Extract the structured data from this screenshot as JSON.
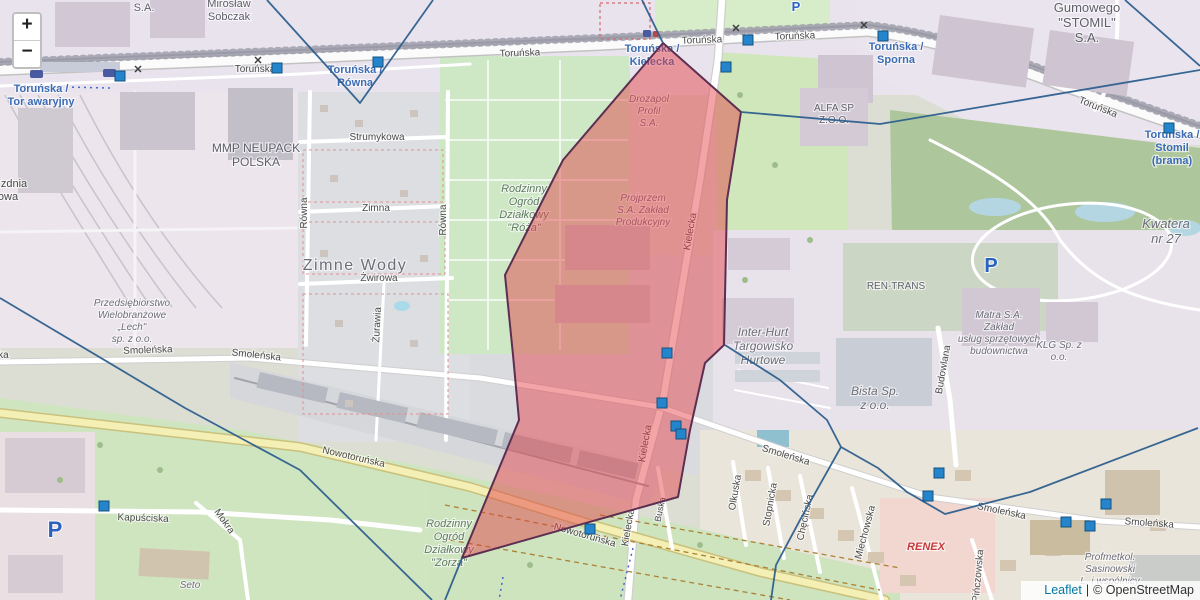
{
  "zoom_control": {
    "zoom_in": "+",
    "zoom_out": "−"
  },
  "attribution": {
    "leaflet_link": "Leaflet",
    "separator": "|",
    "osm_credit": "© OpenStreetMap"
  },
  "map_overlay": {
    "highlight_polygon": {
      "fill": "rgba(228,62,68,0.47)",
      "stroke": "#5c2e52",
      "points": [
        [
          663,
          43
        ],
        [
          741,
          112
        ],
        [
          727,
          200
        ],
        [
          724,
          345
        ],
        [
          705,
          363
        ],
        [
          690,
          430
        ],
        [
          678,
          497
        ],
        [
          462,
          558
        ],
        [
          519,
          420
        ],
        [
          513,
          355
        ],
        [
          505,
          275
        ],
        [
          563,
          160
        ]
      ]
    },
    "boundary_lines": {
      "color": "#2e5f8e",
      "paths": [
        [
          [
            267,
            0
          ],
          [
            360,
            103
          ],
          [
            433,
            0
          ]
        ],
        [
          [
            642,
            0
          ],
          [
            663,
            43
          ]
        ],
        [
          [
            741,
            112
          ],
          [
            880,
            124
          ],
          [
            1200,
            70
          ]
        ],
        [
          [
            1125,
            0
          ],
          [
            1200,
            66
          ]
        ],
        [
          [
            0,
            298
          ],
          [
            185,
            408
          ],
          [
            300,
            470
          ],
          [
            432,
            600
          ]
        ],
        [
          [
            462,
            558
          ],
          [
            445,
            600
          ]
        ],
        [
          [
            725,
            345
          ],
          [
            780,
            380
          ],
          [
            827,
            420
          ],
          [
            841,
            447
          ],
          [
            878,
            468
          ],
          [
            907,
            492
          ],
          [
            945,
            514
          ],
          [
            1030,
            492
          ],
          [
            1198,
            428
          ]
        ],
        [
          [
            841,
            447
          ],
          [
            800,
            520
          ],
          [
            776,
            565
          ],
          [
            771,
            600
          ]
        ]
      ]
    },
    "markers": {
      "color": "#2484cc",
      "border": "#15527e",
      "positions": [
        [
          120,
          76
        ],
        [
          277,
          68
        ],
        [
          378,
          62
        ],
        [
          726,
          67
        ],
        [
          748,
          40
        ],
        [
          883,
          36
        ],
        [
          1169,
          128
        ],
        [
          667,
          353
        ],
        [
          662,
          403
        ],
        [
          676,
          426
        ],
        [
          681,
          434
        ],
        [
          590,
          529
        ],
        [
          104,
          506
        ],
        [
          939,
          473
        ],
        [
          928,
          496
        ],
        [
          1066,
          522
        ],
        [
          1090,
          526
        ],
        [
          1106,
          504
        ]
      ]
    },
    "parking_icons": [
      {
        "x": 796,
        "y": 11,
        "s": 13
      },
      {
        "x": 991,
        "y": 272,
        "s": 20
      },
      {
        "x": 55,
        "y": 537,
        "s": 22
      }
    ],
    "crossing_icons": [
      [
        138,
        73
      ],
      [
        258,
        64
      ],
      [
        736,
        32
      ],
      [
        864,
        29
      ]
    ],
    "labels": [
      {
        "t": "Toruńska /\nTor awaryjny",
        "x": 41,
        "y": 92,
        "s": 11,
        "c": "stop"
      },
      {
        "t": "Toruńska /\nRówna",
        "x": 355,
        "y": 73,
        "s": 11,
        "c": "stop"
      },
      {
        "t": "Toruńska /\nKielecka",
        "x": 652,
        "y": 52,
        "s": 11,
        "c": "stop"
      },
      {
        "t": "Toruńska /\nSporna",
        "x": 896,
        "y": 50,
        "s": 11,
        "c": "stop"
      },
      {
        "t": "Toruńska /\nStomil\n(brama)",
        "x": 1172,
        "y": 138,
        "s": 11,
        "c": "stop"
      },
      {
        "t": "Toruńska",
        "x": 255,
        "y": 72,
        "s": 10,
        "c": "street"
      },
      {
        "t": "Toruńska",
        "x": 520,
        "y": 56,
        "s": 10,
        "c": "street",
        "r": -2
      },
      {
        "t": "Toruńska",
        "x": 702,
        "y": 43,
        "s": 10,
        "c": "street",
        "r": -2
      },
      {
        "t": "Toruńska",
        "x": 795,
        "y": 39,
        "s": 10,
        "c": "street",
        "r": -2
      },
      {
        "t": "Toruńska",
        "x": 1097,
        "y": 110,
        "s": 10,
        "c": "street",
        "r": 22
      },
      {
        "t": "Strumykowa",
        "x": 377,
        "y": 140,
        "s": 10,
        "c": "street"
      },
      {
        "t": "Zimna",
        "x": 376,
        "y": 211,
        "s": 10,
        "c": "street"
      },
      {
        "t": "Żwirowa",
        "x": 379,
        "y": 281,
        "s": 10,
        "c": "street"
      },
      {
        "t": "Równa",
        "x": 307,
        "y": 213,
        "s": 10,
        "c": "street",
        "r": -90
      },
      {
        "t": "Równa",
        "x": 446,
        "y": 220,
        "s": 10,
        "c": "street",
        "r": -90
      },
      {
        "t": "Żurawia",
        "x": 380,
        "y": 325,
        "s": 10,
        "c": "street",
        "r": -87
      },
      {
        "t": "Smoleńska",
        "x": 148,
        "y": 353,
        "s": 10,
        "c": "street",
        "r": -2
      },
      {
        "t": "Smoleńska",
        "x": 256,
        "y": 358,
        "s": 10,
        "c": "street",
        "r": 6
      },
      {
        "t": "Smoleńska",
        "x": 785,
        "y": 458,
        "s": 10,
        "c": "street",
        "r": 17
      },
      {
        "t": "Smoleńska",
        "x": 1001,
        "y": 514,
        "s": 10,
        "c": "street",
        "r": 12
      },
      {
        "t": "Smoleńska",
        "x": 1149,
        "y": 526,
        "s": 10,
        "c": "street",
        "r": 4
      },
      {
        "t": "Smoleńska",
        "x": -16,
        "y": 358,
        "s": 10,
        "c": "street"
      },
      {
        "t": "Nowotoruńska",
        "x": 353,
        "y": 460,
        "s": 10,
        "c": "street",
        "r": 13
      },
      {
        "t": "Nowotoruńska",
        "x": 584,
        "y": 538,
        "s": 10,
        "c": "street",
        "r": 16
      },
      {
        "t": "Kapuściska",
        "x": 143,
        "y": 521,
        "s": 10,
        "c": "street",
        "r": 2
      },
      {
        "t": "Mokra",
        "x": 222,
        "y": 523,
        "s": 10,
        "c": "street",
        "r": 55
      },
      {
        "t": "Seto",
        "x": 190,
        "y": 588,
        "s": 10,
        "c": "co"
      },
      {
        "t": "Kielecka",
        "x": 693,
        "y": 232,
        "s": 10,
        "c": "street",
        "r": -80
      },
      {
        "t": "Kielecka",
        "x": 648,
        "y": 444,
        "s": 10,
        "c": "street",
        "r": -80
      },
      {
        "t": "Kielecka",
        "x": 631,
        "y": 528,
        "s": 10,
        "c": "street",
        "r": -80
      },
      {
        "t": "Buska",
        "x": 663,
        "y": 510,
        "s": 9,
        "c": "street",
        "r": -78
      },
      {
        "t": "Olkuska",
        "x": 738,
        "y": 493,
        "s": 10,
        "c": "street",
        "r": -80
      },
      {
        "t": "Stopnicka",
        "x": 773,
        "y": 505,
        "s": 10,
        "c": "street",
        "r": -80
      },
      {
        "t": "Chęcińska",
        "x": 808,
        "y": 518,
        "s": 10,
        "c": "street",
        "r": -78
      },
      {
        "t": "Miechowska",
        "x": 868,
        "y": 533,
        "s": 10,
        "c": "street",
        "r": -75
      },
      {
        "t": "Pińczowska",
        "x": 981,
        "y": 576,
        "s": 10,
        "c": "street",
        "r": -85
      },
      {
        "t": "Budowlana",
        "x": 946,
        "y": 370,
        "s": 10,
        "c": "street",
        "r": -80
      },
      {
        "t": "zdnia",
        "x": 14,
        "y": 187,
        "s": 11,
        "c": "street"
      },
      {
        "t": "owa",
        "x": 8,
        "y": 200,
        "s": 11,
        "c": "street"
      },
      {
        "t": "Zimne Wody",
        "x": 355,
        "y": 270,
        "s": 16,
        "c": "place"
      },
      {
        "t": "S.A.",
        "x": 144,
        "y": 11,
        "s": 11,
        "c": "co2"
      },
      {
        "t": "Mirosław\nSobczak",
        "x": 229,
        "y": 7,
        "s": 11,
        "c": "co2"
      },
      {
        "t": "MMP NEUPACK\nPOLSKA",
        "x": 256,
        "y": 152,
        "s": 12,
        "c": "co2"
      },
      {
        "t": "Gumowego\n\"STOMIL\"\nS.A.",
        "x": 1087,
        "y": 12,
        "s": 13,
        "c": "co2"
      },
      {
        "t": "Drozapol\nProfil\nS.A.",
        "x": 649,
        "y": 102,
        "s": 10,
        "c": "co"
      },
      {
        "t": "Rodzinny\nOgród\nDziałkowy\n\"Róża\"",
        "x": 524,
        "y": 192,
        "s": 11,
        "c": "green"
      },
      {
        "t": "Rodzinny\nOgród\nDziałkowy\n\"Zorza\"",
        "x": 449,
        "y": 527,
        "s": 11,
        "c": "green"
      },
      {
        "t": "Projprzem\nS.A. Zakład\nProdukcyjny",
        "x": 643,
        "y": 201,
        "s": 10,
        "c": "co"
      },
      {
        "t": "ALFA SP\nZ.O.O.",
        "x": 834,
        "y": 111,
        "s": 10,
        "c": "co2"
      },
      {
        "t": "Przedsiębiorstwo\nWielobranżowe\n„Lech\"\nsp. z o.o.",
        "x": 132,
        "y": 306,
        "s": 10,
        "c": "co"
      },
      {
        "t": "REN-TRANS",
        "x": 896,
        "y": 289,
        "s": 10,
        "c": "co2"
      },
      {
        "t": "Inter-Hurt\nTargowisko\nHurtowe",
        "x": 763,
        "y": 336,
        "s": 12,
        "c": "co"
      },
      {
        "t": "Bista Sp.\nz o.o.",
        "x": 875,
        "y": 395,
        "s": 12,
        "c": "co"
      },
      {
        "t": "Matra S.A.\nZakład\nusług sprzętowych\nbudownictwa",
        "x": 999,
        "y": 318,
        "s": 10,
        "c": "co"
      },
      {
        "t": "KLG Sp. z\no.o.",
        "x": 1059,
        "y": 348,
        "s": 10,
        "c": "co"
      },
      {
        "t": "Kwatera\nnr 27",
        "x": 1166,
        "y": 228,
        "s": 13,
        "c": "co"
      },
      {
        "t": "Profmetkol.\nSasinowski\nL. i wspólnicy",
        "x": 1110,
        "y": 560,
        "s": 10,
        "c": "co"
      },
      {
        "t": "RENEX",
        "x": 926,
        "y": 550,
        "s": 11,
        "c": "red"
      }
    ]
  }
}
